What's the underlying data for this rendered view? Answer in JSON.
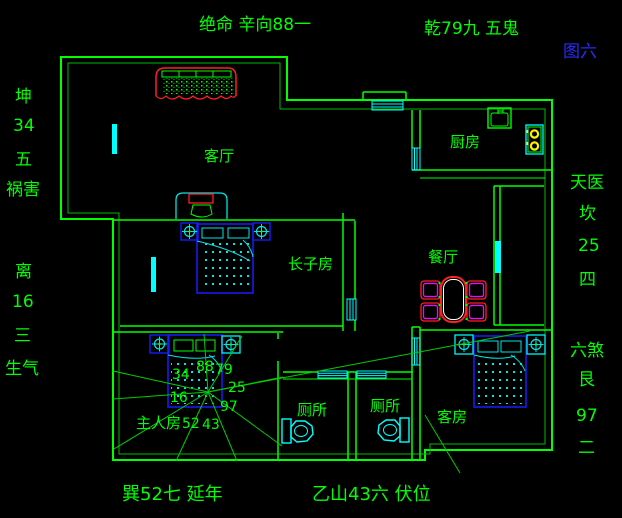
{
  "figure": {
    "label": "图六"
  },
  "annotations": {
    "top_left": "绝命 辛向88一",
    "top_right": "乾79九 五鬼",
    "left_top": [
      "坤",
      "34",
      "五",
      "祸害"
    ],
    "left_bottom": [
      "离",
      "16",
      "三",
      "生气"
    ],
    "right_top": [
      "天医",
      "坎",
      "25",
      "四"
    ],
    "right_bottom": [
      "六煞",
      "艮",
      "97",
      "二"
    ],
    "bottom_left": "巽52七 延年",
    "bottom_right": "乙山43六 伏位"
  },
  "rooms": {
    "living": "客厅",
    "kitchen": "厨房",
    "dining": "餐厅",
    "eldest_son": "长子房",
    "master": "主人房",
    "toilet1": "厕所",
    "toilet2": "厕所",
    "guest": "客房"
  },
  "compass": {
    "n": "88",
    "ne": "79",
    "w": "34",
    "e": "25",
    "sw": "16",
    "se": "97",
    "s_left": "52",
    "s_right": "43"
  },
  "colors": {
    "background": "#000000",
    "wall_green": "#00ff00",
    "overlay_green": "#00cc00",
    "window_cyan": "#00ffff",
    "furniture_blue": "#1a1aff",
    "accent_red": "#ff2020",
    "accent_magenta": "#ff00ff",
    "burner_yellow": "#ffee00",
    "figure_blue": "#2a2aff",
    "table_white": "#ffffff"
  }
}
